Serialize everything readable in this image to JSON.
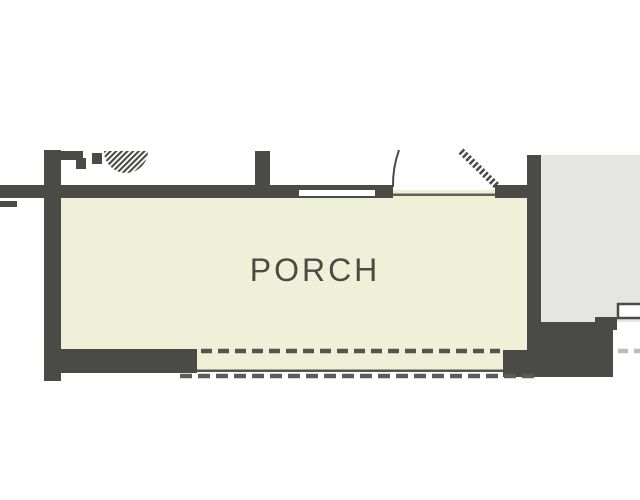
{
  "floor_plan": {
    "room_label": "PORCH",
    "colors": {
      "background": "#ffffff",
      "wall": "#4a4a47",
      "porch_floor": "#eef0d7",
      "adjacent_floor": "#e5e5e1",
      "label_text": "#4b4b46",
      "threshold_line": "#5f5f58",
      "step_edge_line": "#55544f",
      "dash_dark": "#55544f",
      "dash_medium": "#5c5c56",
      "dash_light": "#bcbcb6"
    },
    "icons": [
      "ceiling-fan-icon",
      "door-swing-arc-icon",
      "door-leaf-icon",
      "window-icon",
      "dashed-step-edge-icon"
    ]
  }
}
